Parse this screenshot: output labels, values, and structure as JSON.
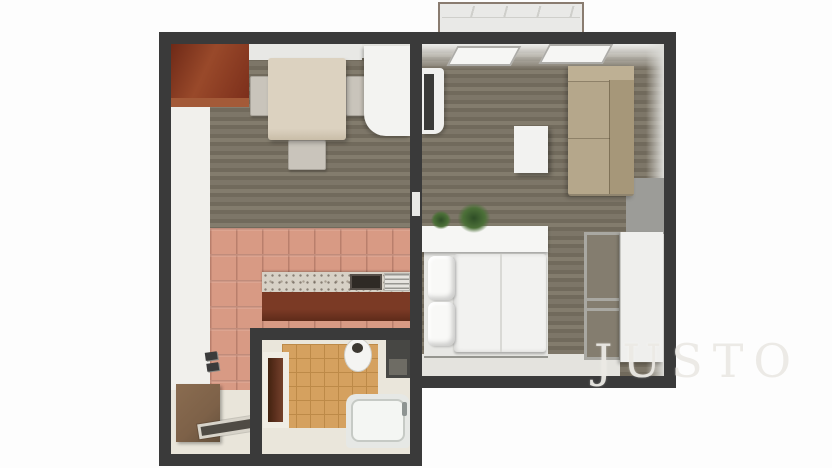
{
  "watermark": {
    "text": "JUSTO"
  },
  "scene": {
    "type": "3d-floor-plan-top-view",
    "rooms": [
      {
        "id": "kitchen-dining",
        "furniture": [
          "corner-wood-cabinet",
          "window",
          "dining-table",
          "chair",
          "chair",
          "chair",
          "fridge",
          "kitchen-counter",
          "stove",
          "sink"
        ]
      },
      {
        "id": "living-bedroom",
        "furniture": [
          "tv-stand",
          "tv",
          "coffee-table",
          "sofa",
          "plants",
          "double-bed",
          "pillows",
          "headboard-shelf",
          "open-shelf-unit",
          "wardrobe"
        ]
      },
      {
        "id": "bathroom",
        "furniture": [
          "door",
          "toilet",
          "washing-machine",
          "bathtub"
        ]
      },
      {
        "id": "entry-hall",
        "furniture": [
          "cabinet",
          "doormat",
          "intercom"
        ]
      },
      {
        "id": "balcony",
        "furniture": [
          "railing"
        ]
      }
    ]
  },
  "colors": {
    "wall": "#3a3a3a",
    "wood_a": "#7d7668",
    "wood_b": "#716a5c",
    "wood_c": "#837c6d",
    "tile": "#d89a84",
    "tile_line": "#b97f6c",
    "bath_floor": "#d5a15f",
    "bath_line": "#bd8a48",
    "hall_floor": "#f1f0ec",
    "entry_floor": "#e9e5da",
    "bath_interior": "#eae6db",
    "cabinet_top": "#7c2f1b",
    "cabinet_front": "#a35a38",
    "window_pane": "#fcfcfb",
    "table": "#dcd2c0",
    "chair": "#c9c4bb",
    "fridge": "#f3f3f1",
    "marble": "#d7d1c6",
    "counter_front": "#7b3a25",
    "stove": "#2f2a25",
    "sink": "#e6e4df",
    "door_brown": "#5f3220",
    "toilet": "#f4f4f2",
    "washer": "#474744",
    "tub": "#e6e8e5",
    "entry_cabinet": "#7d6148",
    "mat_dark": "#4f4b44",
    "mat_border": "#d7d3c9",
    "balcony": "#e9e9e7",
    "balcony_border": "#8a7c70",
    "balcony_line": "#cfcfcb",
    "tv": "#3a3a38",
    "tv_stand": "#f0f0ee",
    "coffee_table": "#f2f2f0",
    "sofa": "#b5a78b",
    "sofa_back": "#a69779",
    "sofa_arm": "#beb094",
    "gray_mat": "#9c9c98",
    "plant_dark": "#2e4d26",
    "plant_mid": "#4c7038",
    "headboard": "#f6f6f4",
    "bed_base": "#e7e7e4",
    "duvet": "#f2f2f0",
    "pillow": "#f9f9f7",
    "floor_strip": "#e4e3de",
    "shelf_bg": "#847d6f",
    "shelf_frame": "#a9a8a2",
    "wardrobe": "#efefed",
    "watermark": "#eceae5"
  }
}
